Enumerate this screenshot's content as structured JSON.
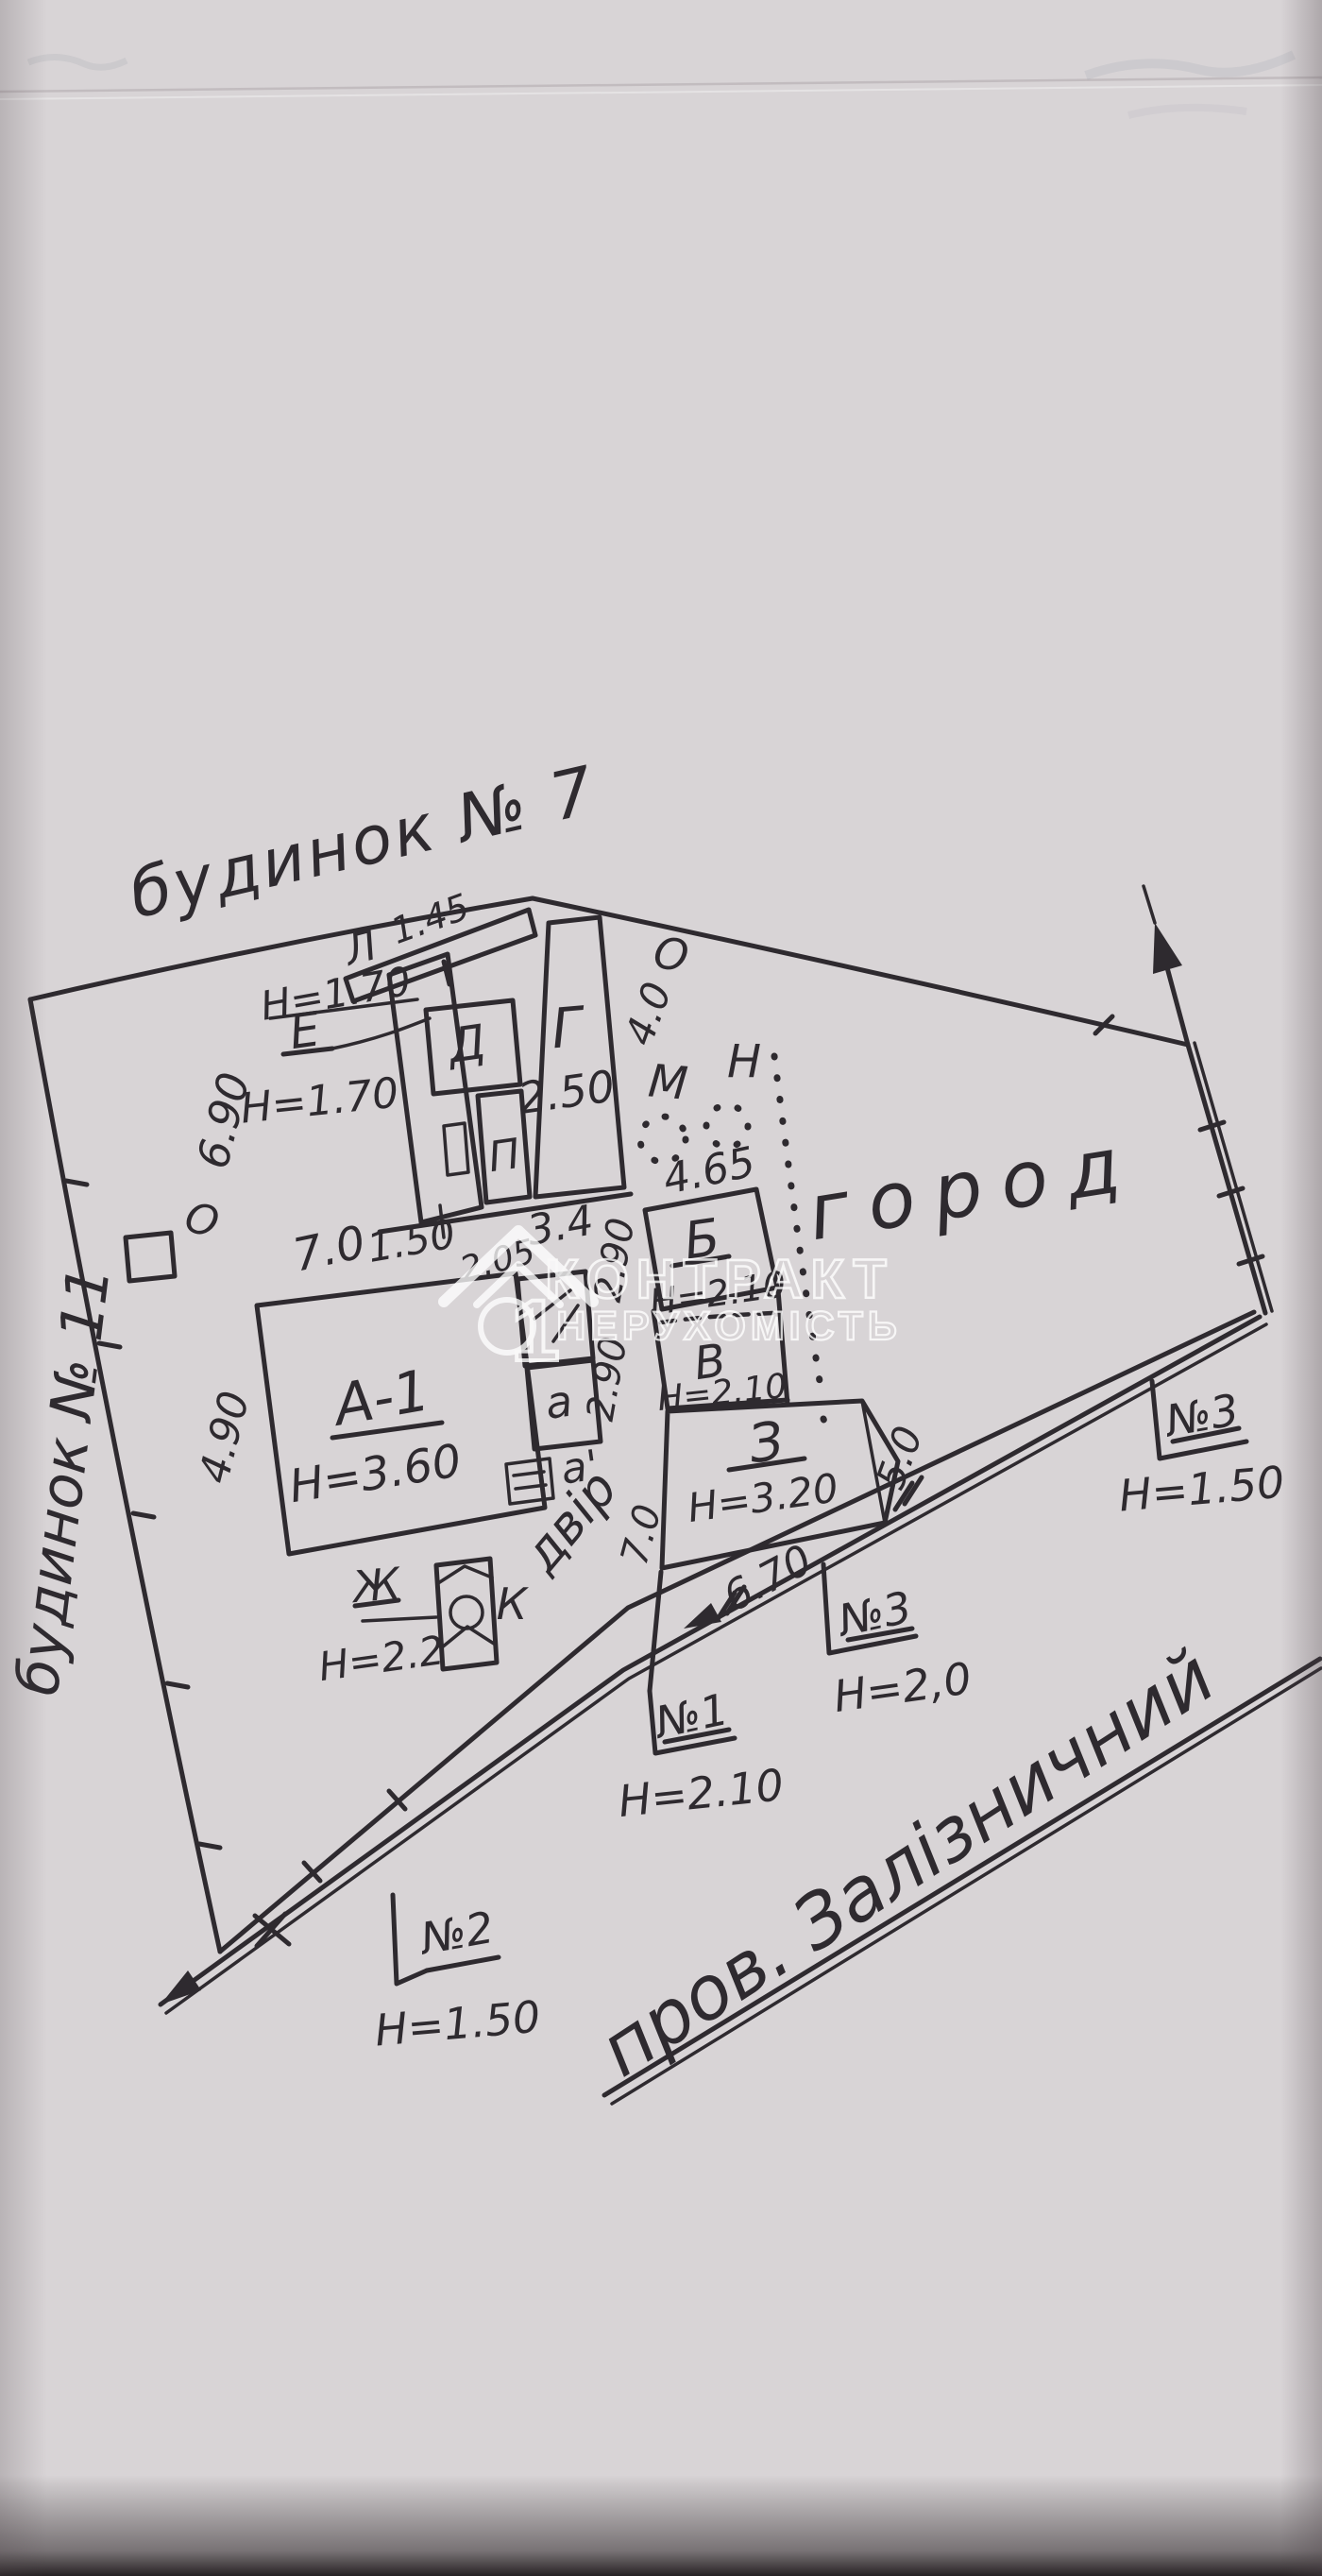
{
  "colors": {
    "paper": "#d8d4d6",
    "ink": "#2e2a2f",
    "watermark": "#ffffff"
  },
  "neighbors": {
    "top_label": "будинок № 7",
    "left_label": "будинок № 11"
  },
  "street": {
    "label": "пров. Залізничний"
  },
  "zones": {
    "garden": "город",
    "yard": "двір"
  },
  "buildings": {
    "a1": {
      "label": "А-1",
      "height": "Н=3.60",
      "top_dim": "7.0",
      "side_dim": "4.90"
    },
    "g": {
      "label": "Г",
      "value": "2.50"
    },
    "d": {
      "label": "Д"
    },
    "p": {
      "label": "П"
    },
    "l": {
      "label": "Л",
      "dim": "1.45"
    },
    "e": {
      "label": "Е",
      "height_top": "Н=1.70",
      "height_bottom": "Н=1.70"
    },
    "b": {
      "label": "Б",
      "height": "Н=2.10",
      "top_dim": "4.65",
      "side_dim": "2.90"
    },
    "v": {
      "label": "В",
      "height": "Н=2.10",
      "side_dim": "2.90"
    },
    "z": {
      "label": "З",
      "height": "Н=3.20",
      "right_dim": "5.0",
      "left_dim": "7.0"
    },
    "zh": {
      "label": "Ж",
      "height": "Н=2.2"
    },
    "k": {
      "label": "К"
    },
    "m": {
      "label": "М"
    },
    "n": {
      "label": "Н"
    },
    "o_shed": {
      "label": "О",
      "dim": "4.0"
    },
    "o_well": {
      "label": "О"
    },
    "a_annex": {
      "label": "а"
    },
    "a_annex2": {
      "label": "а'"
    }
  },
  "cluster_dims": {
    "height": "6.90",
    "w1": "1.50",
    "w2": "3.4",
    "gap": "2.05"
  },
  "fence_marks": {
    "n1": {
      "label": "№1",
      "height": "Н=2.10"
    },
    "n2": {
      "label": "№2",
      "height": "Н=1.50"
    },
    "n3_mid": {
      "label": "№3",
      "height": "Н=2,0"
    },
    "n3_right": {
      "label": "№3",
      "height": "Н=1.50"
    },
    "span": "6.70"
  },
  "watermark": {
    "brand_line1": "КОНТРАКТ",
    "brand_line2": "НЕРУХОМІСТЬ",
    "logo_number": "1"
  }
}
